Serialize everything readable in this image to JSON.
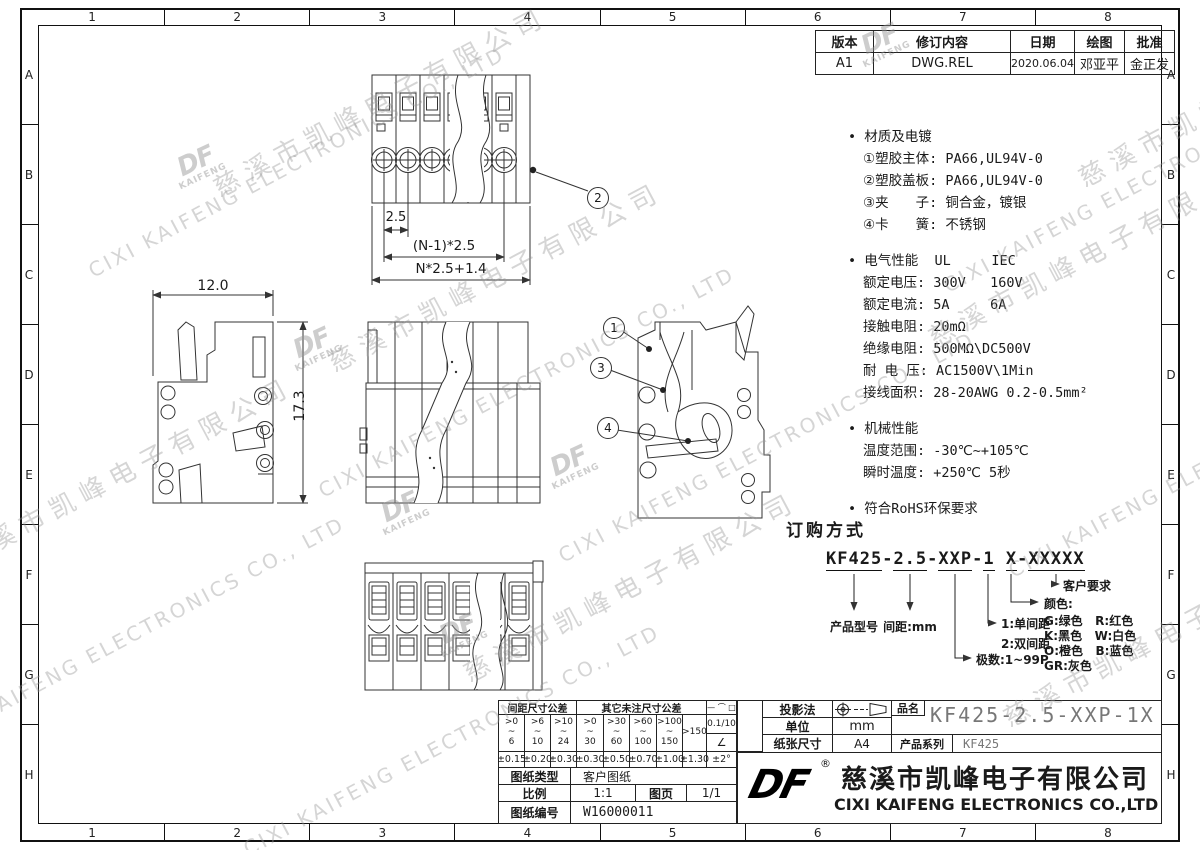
{
  "frame": {
    "cols": [
      "1",
      "2",
      "3",
      "4",
      "5",
      "6",
      "7",
      "8"
    ],
    "rows": [
      "A",
      "B",
      "C",
      "D",
      "E",
      "F",
      "G",
      "H"
    ]
  },
  "watermark": {
    "cn": "慈溪市凯峰电子有限公司",
    "en": "CIXI KAIFENG ELECTRONICS CO., LTD",
    "logo_top": "DF",
    "logo_bottom": "KAIFENG"
  },
  "revision": {
    "headers": [
      "版本",
      "修订内容",
      "日期",
      "绘图",
      "批准"
    ],
    "row": [
      "A1",
      "DWG.REL",
      "2020.06.04",
      "邓亚平",
      "金正发"
    ]
  },
  "specs": {
    "material_title": "• 材质及电镀",
    "material_lines": [
      "①塑胶主体: PA66,UL94V-0",
      "②塑胶盖板: PA66,UL94V-0",
      "③夹　　子: 铜合金，镀银",
      "④卡　　簧: 不锈钢"
    ],
    "electrical_title": "• 电气性能  UL     IEC",
    "electrical_lines": [
      "额定电压: 300V   160V",
      "额定电流: 5A     6A",
      "接触电阻: 20mΩ",
      "绝缘电阻: 500MΩ\\DC500V",
      "耐 电 压: AC1500V\\1Min",
      "接线面积: 28-20AWG 0.2-0.5mm²"
    ],
    "mechanical_title": "• 机械性能",
    "mechanical_lines": [
      "温度范围: -30℃~+105℃",
      "瞬时温度: +250℃ 5秒"
    ],
    "rohs": "• 符合RoHS环保要求"
  },
  "dims": {
    "pitch": "2.5",
    "n_pitch": "(N-1)*2.5",
    "overall": "N*2.5+1.4",
    "width": "12.0",
    "height": "17.3",
    "balloon1": "1",
    "balloon2": "2",
    "balloon3": "3",
    "balloon4": "4"
  },
  "ordering": {
    "title": "订购方式",
    "pn_segments": [
      "KF425",
      "2.5",
      "XXP",
      "1",
      "X",
      "XXXXX"
    ],
    "pn_separators": [
      "-",
      "-",
      "-",
      " ",
      "-"
    ],
    "label_model": "产品型号",
    "label_pitch": "间距:mm",
    "label_poles": "极数:1~99P",
    "label_single": "1:单间距",
    "label_double": "2:双间距",
    "label_customer": "客户要求",
    "label_color": "颜色:",
    "colors": [
      "G:绿色   R:红色",
      "K:黑色   W:白色",
      "O:橙色   B:蓝色",
      "GR:灰色"
    ]
  },
  "title_block": {
    "tol_pitch_header": "间距尺寸公差",
    "tol_other_header": "其它未注尺寸公差",
    "tol_symbols": "— ⌒ □",
    "tol_ranges": [
      ">0\n~\n6",
      ">6\n~\n10",
      ">10\n~\n24",
      ">0\n~\n30",
      ">30\n~\n60",
      ">60\n~\n100",
      ">100\n~\n150",
      ">150"
    ],
    "tol_values": [
      "±0.15",
      "±0.20",
      "±0.30",
      "±0.30",
      "±0.50",
      "±0.70",
      "±1.00",
      "±1.30"
    ],
    "tol_flatness": "0.1/10",
    "tol_angle_sym": "∠",
    "tol_angle": "±2°",
    "doc_type_label": "图纸类型",
    "doc_type": "客户图纸",
    "scale_label": "比例",
    "scale": "1:1",
    "sheet_label": "图页",
    "sheet": "1/1",
    "number_label": "图纸编号",
    "number": "W16000011",
    "projection_label": "投影法",
    "unit_label": "单位",
    "unit": "mm",
    "paper_label": "纸张尺寸",
    "paper": "A4",
    "part_label": "品名",
    "part_name": "KF425-2.5-XXP-1X",
    "series_label": "产品系列",
    "series": "KF425",
    "logo": "DF",
    "registered": "®",
    "company_cn": "慈溪市凯峰电子有限公司",
    "company_en": "CIXI KAIFENG ELECTRONICS CO.,LTD"
  }
}
